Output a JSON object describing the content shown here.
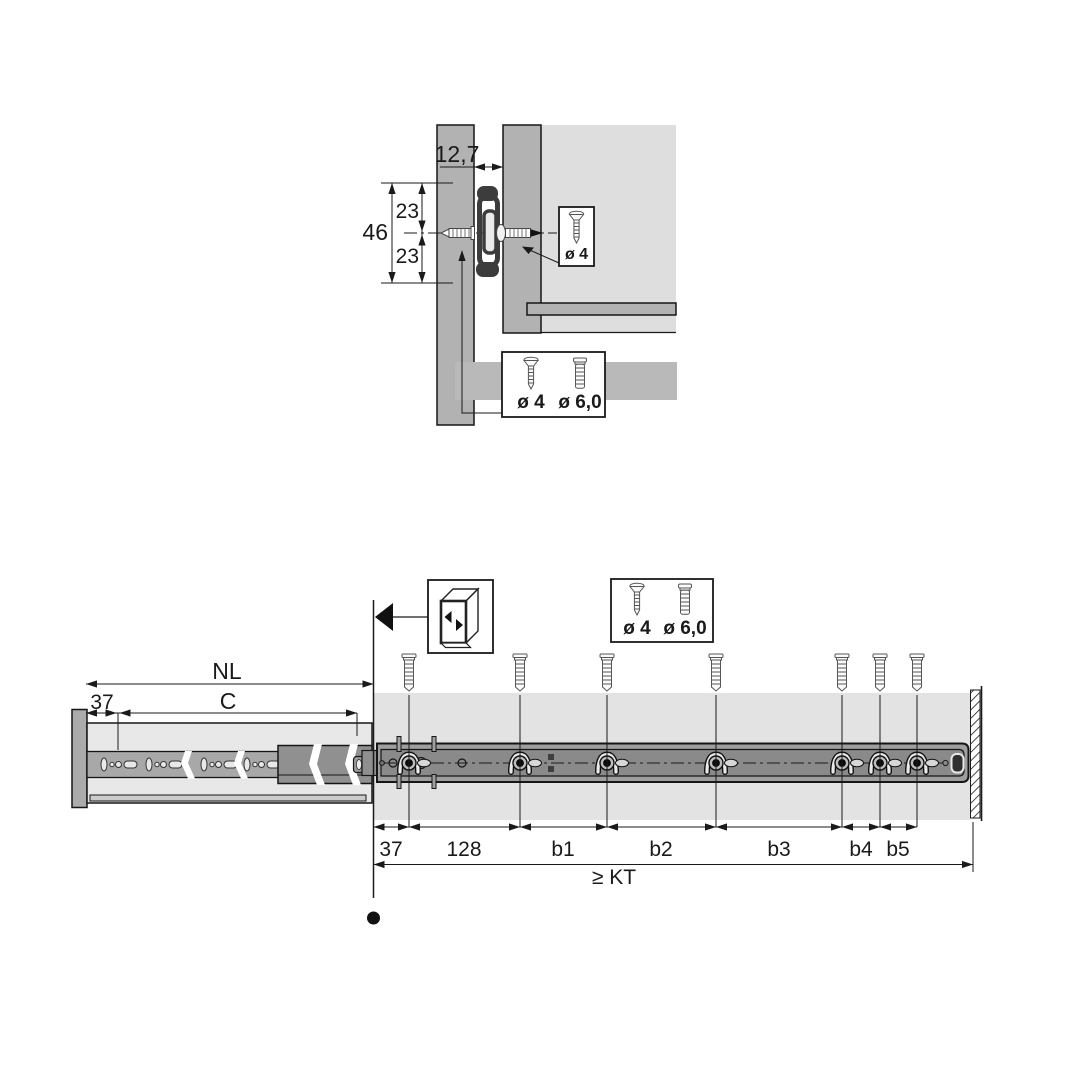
{
  "colors": {
    "outline": "#1a1a1a",
    "panel_gray": "#b2b2b2",
    "interior_light_gray": "#dedede",
    "cabinet_band_gray": "#e3e3e3",
    "drawer_body_gray": "#e8e8e8",
    "runner_strip_gray": "#a8a8a8",
    "rail_dark_gray": "#8a8a8a",
    "slide_profile_dark": "#3c3c3c",
    "background": "#ffffff"
  },
  "top_view": {
    "gap_dim": "12,7",
    "height_total_dim": "46",
    "hole_upper_dim": "23",
    "hole_lower_dim": "23",
    "side_screw_box": {
      "label": "ø 4",
      "icon": "countersunk-screw-icon"
    },
    "bottom_screw_box": {
      "small_label": "ø 4",
      "large_label": "ø 6,0",
      "icons": [
        "countersunk-screw-icon",
        "pan-head-screw-icon"
      ]
    }
  },
  "side_view": {
    "length_dim": "NL",
    "screw_zone_dim": "C",
    "front_offset_dim": "37",
    "cabinet_icon": "cabinet-open-front-icon",
    "screw_box": {
      "small_label": "ø 4",
      "large_label": "ø 6,0",
      "icons": [
        "countersunk-screw-icon",
        "pan-head-screw-icon"
      ]
    },
    "hole_spacing_dims": [
      "37",
      "128",
      "b1",
      "b2",
      "b3",
      "b4",
      "b5"
    ],
    "depth_dim": "≥ KT",
    "mounting_screw_count": 7
  }
}
